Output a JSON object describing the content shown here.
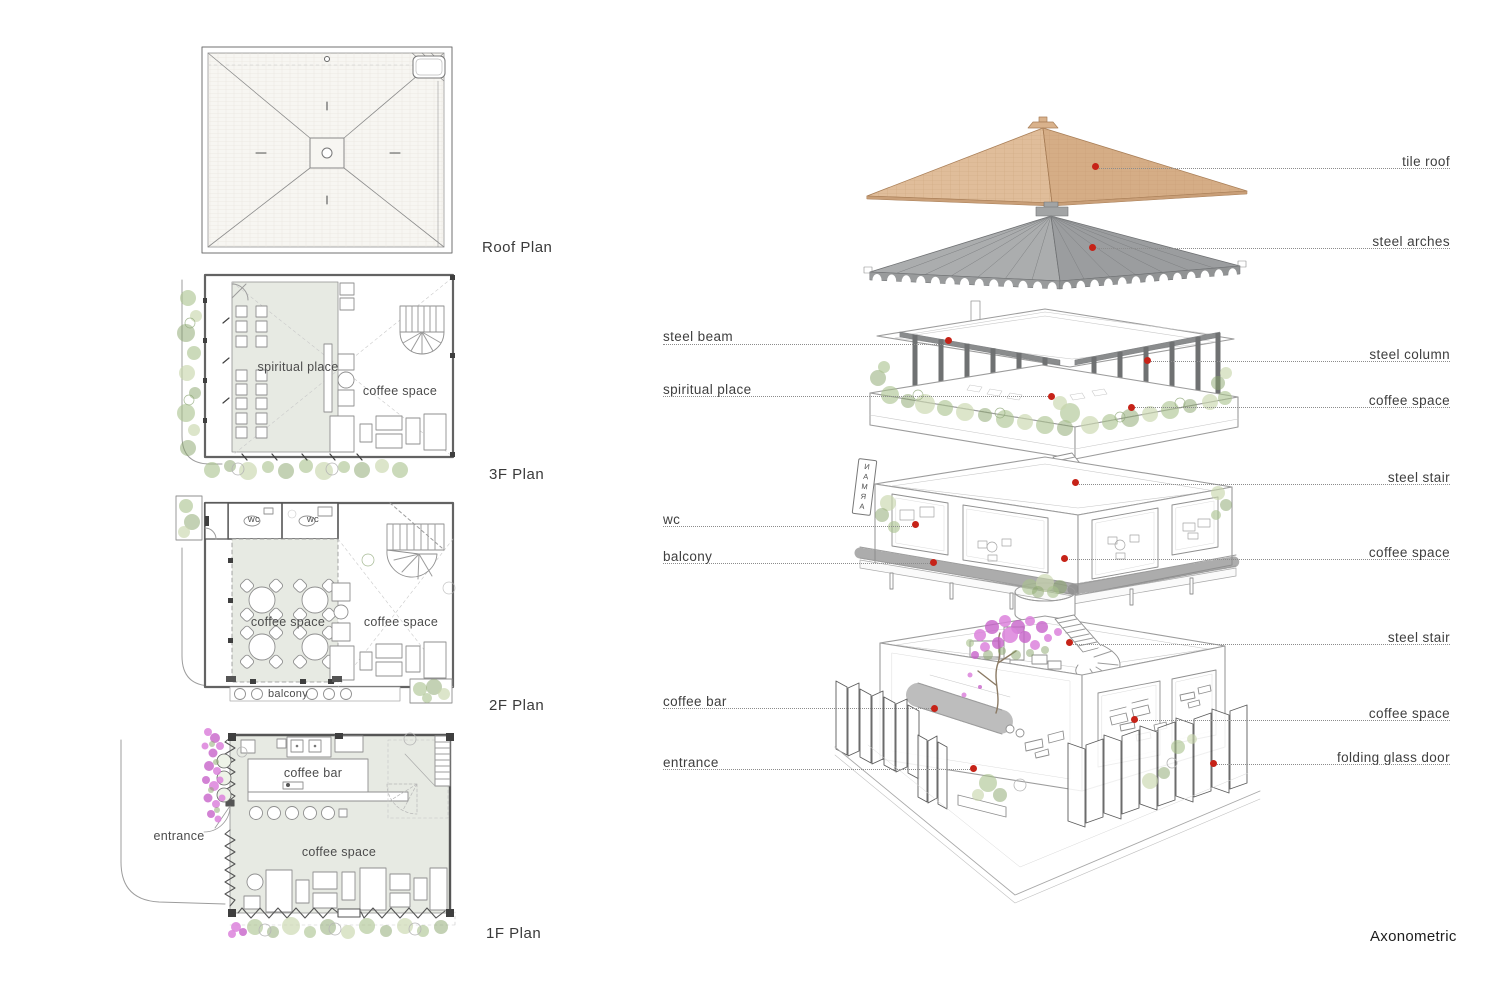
{
  "plans": {
    "roof": {
      "title": "Roof Plan"
    },
    "f3": {
      "title": "3F Plan",
      "room_spiritual": "spiritual place",
      "room_coffee": "coffee space"
    },
    "f2": {
      "title": "2F Plan",
      "wc_left": "wc",
      "wc_right": "wc",
      "room_coffee_left": "coffee space",
      "room_coffee_right": "coffee space",
      "balcony": "balcony"
    },
    "f1": {
      "title": "1F Plan",
      "coffee_bar": "coffee bar",
      "coffee_space": "coffee space",
      "entrance": "entrance"
    }
  },
  "axon": {
    "title": "Axonometric",
    "sign": "NAMRA",
    "left_labels": [
      "steel beam",
      "spiritual place",
      "wc",
      "balcony",
      "coffee bar",
      "entrance"
    ],
    "right_labels": [
      "tile roof",
      "steel arches",
      "steel column",
      "coffee space",
      "steel stair",
      "coffee space",
      "steel stair",
      "coffee space",
      "folding glass door"
    ]
  },
  "colors": {
    "marker_red": "#c62318",
    "tile_tan": "#d9b28c",
    "steel_gray": "#a3a5a6",
    "plan_shade": "#e7eae3",
    "plant_green": "#a9c18c",
    "flower_pink": "#dc82dc"
  }
}
